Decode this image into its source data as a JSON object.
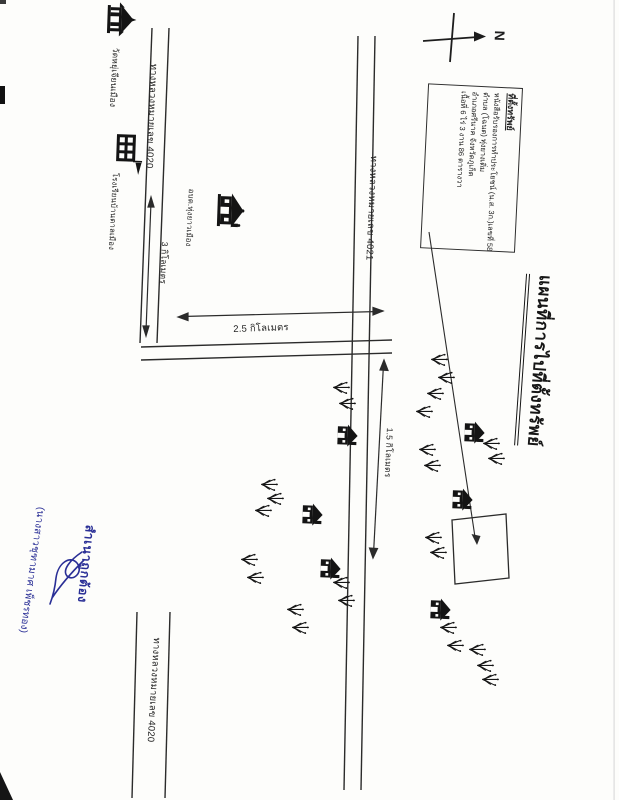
{
  "map": {
    "title": "แผนที่การไปที่ตั้งทรัพย์",
    "compass_label": "N"
  },
  "info_box": {
    "header": "ที่ตั้งทรัพย์",
    "line1": "หนังสือรับรองการทำประโยชน์ (น.ส. 3ก.)เลขที่ 5870",
    "line2": "ตำบล (โฉนด) ทุ่งยางเติ่ม",
    "line3": "อำเภอศรีนาค จังหวัดภูเก็ต",
    "line4": "เนื้อที่ 6 ไร่ 3 งาน 86 ตารางวา"
  },
  "roads": {
    "top_left": "ทางหลวงหมายเลข 4020",
    "middle": "ทางหลวงหมายเลข 4021",
    "bottom": "ทางหลวงหมายเลข 4020"
  },
  "distances": {
    "left_road": "3 กิโลเมตร",
    "horizontal_road": "2.5 กิโลเมตร",
    "middle_road": "1.5 กิโลเมตร"
  },
  "places": {
    "temple": "วัดหยุ่เจียนเมือง",
    "school": "โรงเรียนบ้านตาลเมือง",
    "sao_office": "อบต.ทุ่งยาวเมือง"
  },
  "certification": {
    "stamp": "สำเนาถูกต้อง",
    "signer_name": "(นางสาวชุฑามาศ เพ็ชรทอง)"
  },
  "colors": {
    "ink": "#222222",
    "stamp_blue": "#2a2f96",
    "paper": "#fdfdfb"
  }
}
